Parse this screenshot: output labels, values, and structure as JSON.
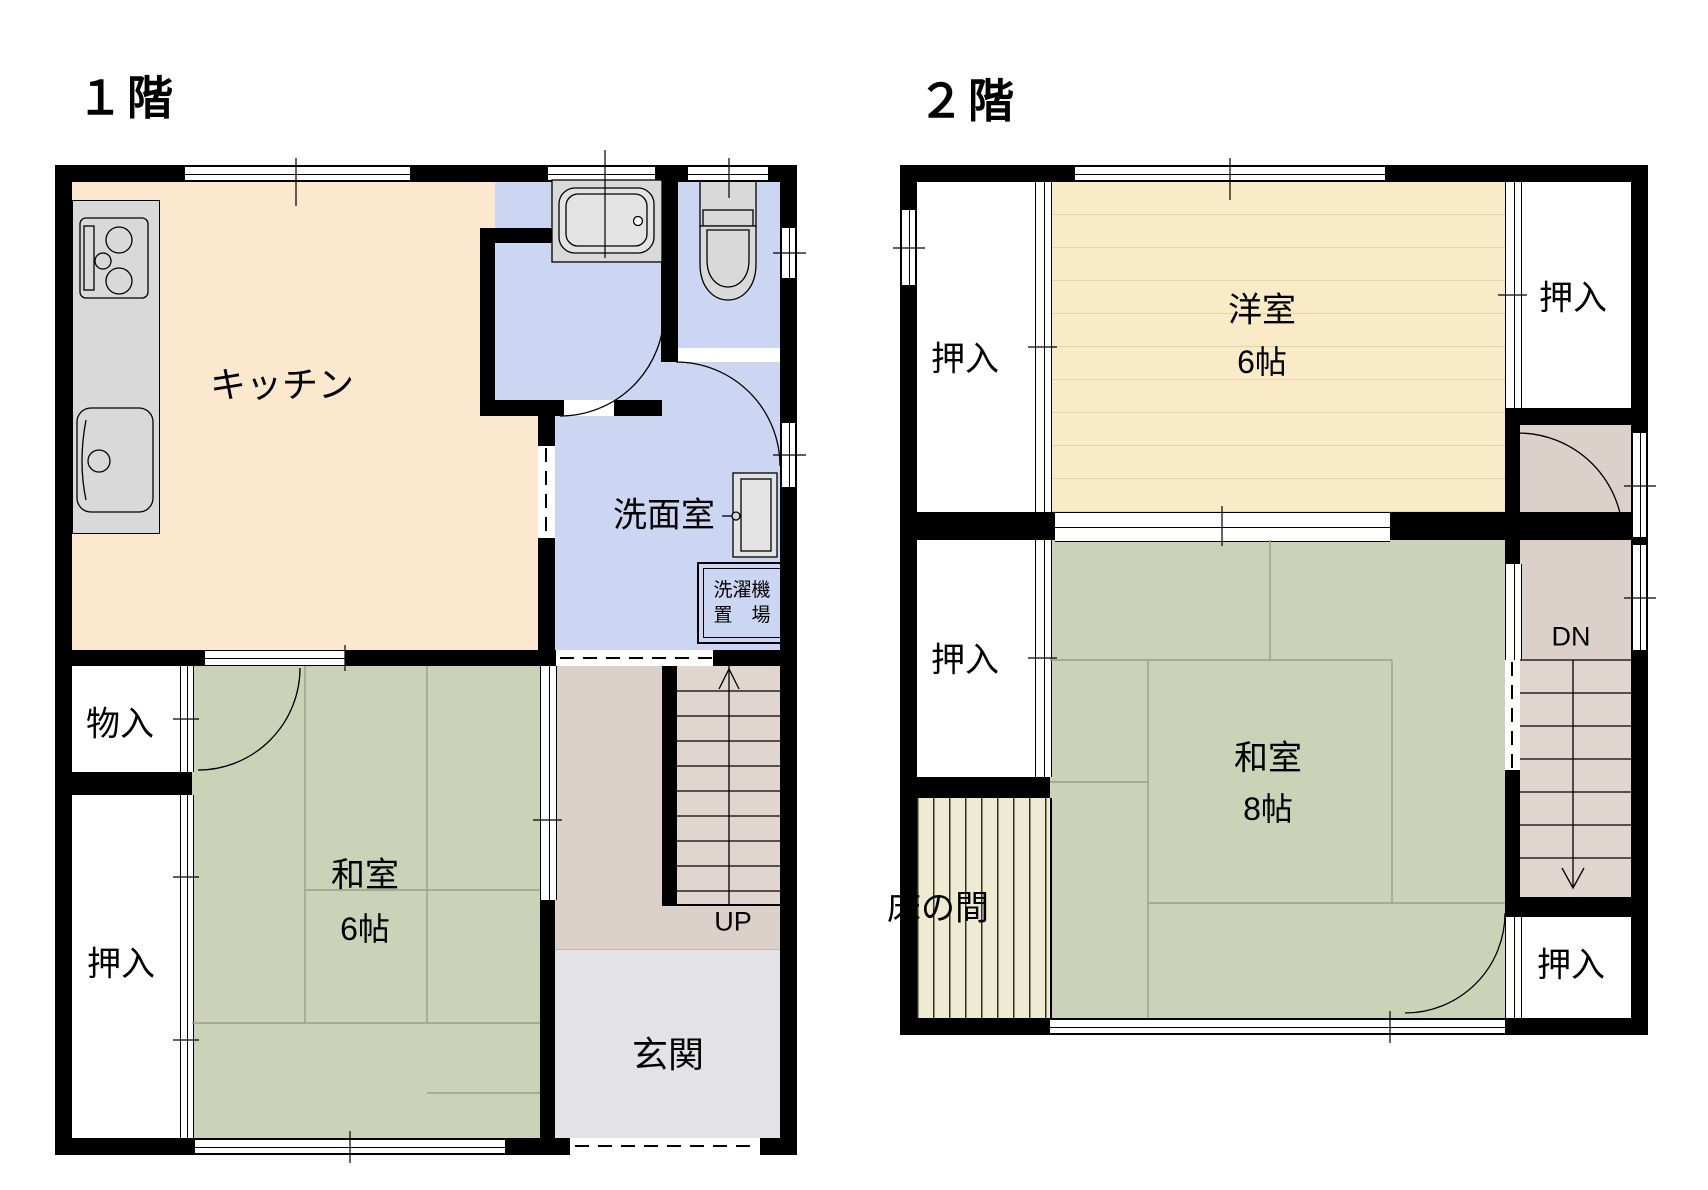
{
  "colors": {
    "wall": "#000000",
    "kitchen": "#fce8cf",
    "water": "#ccd6f2",
    "tatami": "#ccd2b8",
    "hall": "#dcd0ca",
    "stair": "#e0d5cf",
    "entrance": "#e3e2e4",
    "western": "#f9ebc7",
    "western_line": "#e2d4a9",
    "tokonoma": "#eeebd3",
    "fixture": "#d9d9d9",
    "grid": "#9aa083"
  },
  "floor1": {
    "title": "１階",
    "labels": {
      "kitchen": "キッチン",
      "washroom": "洗面室",
      "laundry_line1": "洗濯機",
      "laundry_line2": "置　場",
      "storage": "物入",
      "closet": "押入",
      "tatami_name": "和室",
      "tatami_size": "6帖",
      "entrance": "玄関",
      "stairs": "UP"
    }
  },
  "floor2": {
    "title": "２階",
    "labels": {
      "closet_top_left": "押入",
      "closet_top_right": "押入",
      "closet_mid_left": "押入",
      "closet_bottom_right": "押入",
      "western_name": "洋室",
      "western_size": "6帖",
      "tatami_name": "和室",
      "tatami_size": "8帖",
      "tokonoma": "床の間",
      "stairs": "DN"
    }
  }
}
